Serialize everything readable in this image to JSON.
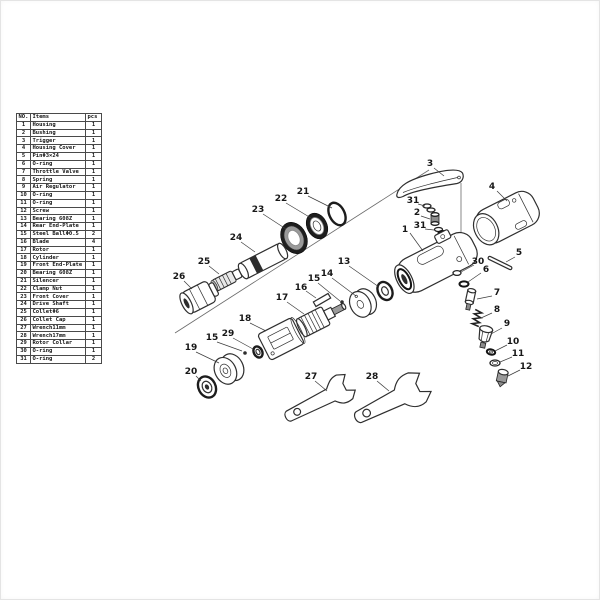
{
  "parts_table": {
    "headers": {
      "no": "NO.",
      "items": "Items",
      "pcs": "pcs"
    },
    "rows": [
      {
        "no": "1",
        "item": "Housing",
        "pcs": "1"
      },
      {
        "no": "2",
        "item": "Bushing",
        "pcs": "1"
      },
      {
        "no": "3",
        "item": "Trigger",
        "pcs": "1"
      },
      {
        "no": "4",
        "item": "Housing Cover",
        "pcs": "1"
      },
      {
        "no": "5",
        "item": "PinΦ3×24",
        "pcs": "1"
      },
      {
        "no": "6",
        "item": "O-ring",
        "pcs": "1"
      },
      {
        "no": "7",
        "item": "Throttle Valve",
        "pcs": "1"
      },
      {
        "no": "8",
        "item": "Spring",
        "pcs": "1"
      },
      {
        "no": "9",
        "item": "Air Regulator",
        "pcs": "1"
      },
      {
        "no": "10",
        "item": "O-ring",
        "pcs": "1"
      },
      {
        "no": "11",
        "item": "O-ring",
        "pcs": "1"
      },
      {
        "no": "12",
        "item": "Screw",
        "pcs": "1"
      },
      {
        "no": "13",
        "item": "Bearing 608Z",
        "pcs": "1"
      },
      {
        "no": "14",
        "item": "Rear End-Plate",
        "pcs": "1"
      },
      {
        "no": "15",
        "item": "Steel BallΦ0.5",
        "pcs": "2"
      },
      {
        "no": "16",
        "item": "Blade",
        "pcs": "4"
      },
      {
        "no": "17",
        "item": "Rotor",
        "pcs": "1"
      },
      {
        "no": "18",
        "item": "Cylinder",
        "pcs": "1"
      },
      {
        "no": "19",
        "item": "Front End-Plate",
        "pcs": "1"
      },
      {
        "no": "20",
        "item": "Bearing 608Z",
        "pcs": "1"
      },
      {
        "no": "21",
        "item": "Silencer",
        "pcs": "1"
      },
      {
        "no": "22",
        "item": "Clamp Nut",
        "pcs": "1"
      },
      {
        "no": "23",
        "item": "Front Cover",
        "pcs": "1"
      },
      {
        "no": "24",
        "item": "Drive Shaft",
        "pcs": "1"
      },
      {
        "no": "25",
        "item": "ColletΦ6",
        "pcs": "1"
      },
      {
        "no": "26",
        "item": "Collet Cap",
        "pcs": "1"
      },
      {
        "no": "27",
        "item": "Wrench11mm",
        "pcs": "1"
      },
      {
        "no": "28",
        "item": "Wrench17mm",
        "pcs": "1"
      },
      {
        "no": "29",
        "item": "Rotor Collar",
        "pcs": "1"
      },
      {
        "no": "30",
        "item": "O-ring",
        "pcs": "1"
      },
      {
        "no": "31",
        "item": "O-ring",
        "pcs": "2"
      }
    ]
  }
}
